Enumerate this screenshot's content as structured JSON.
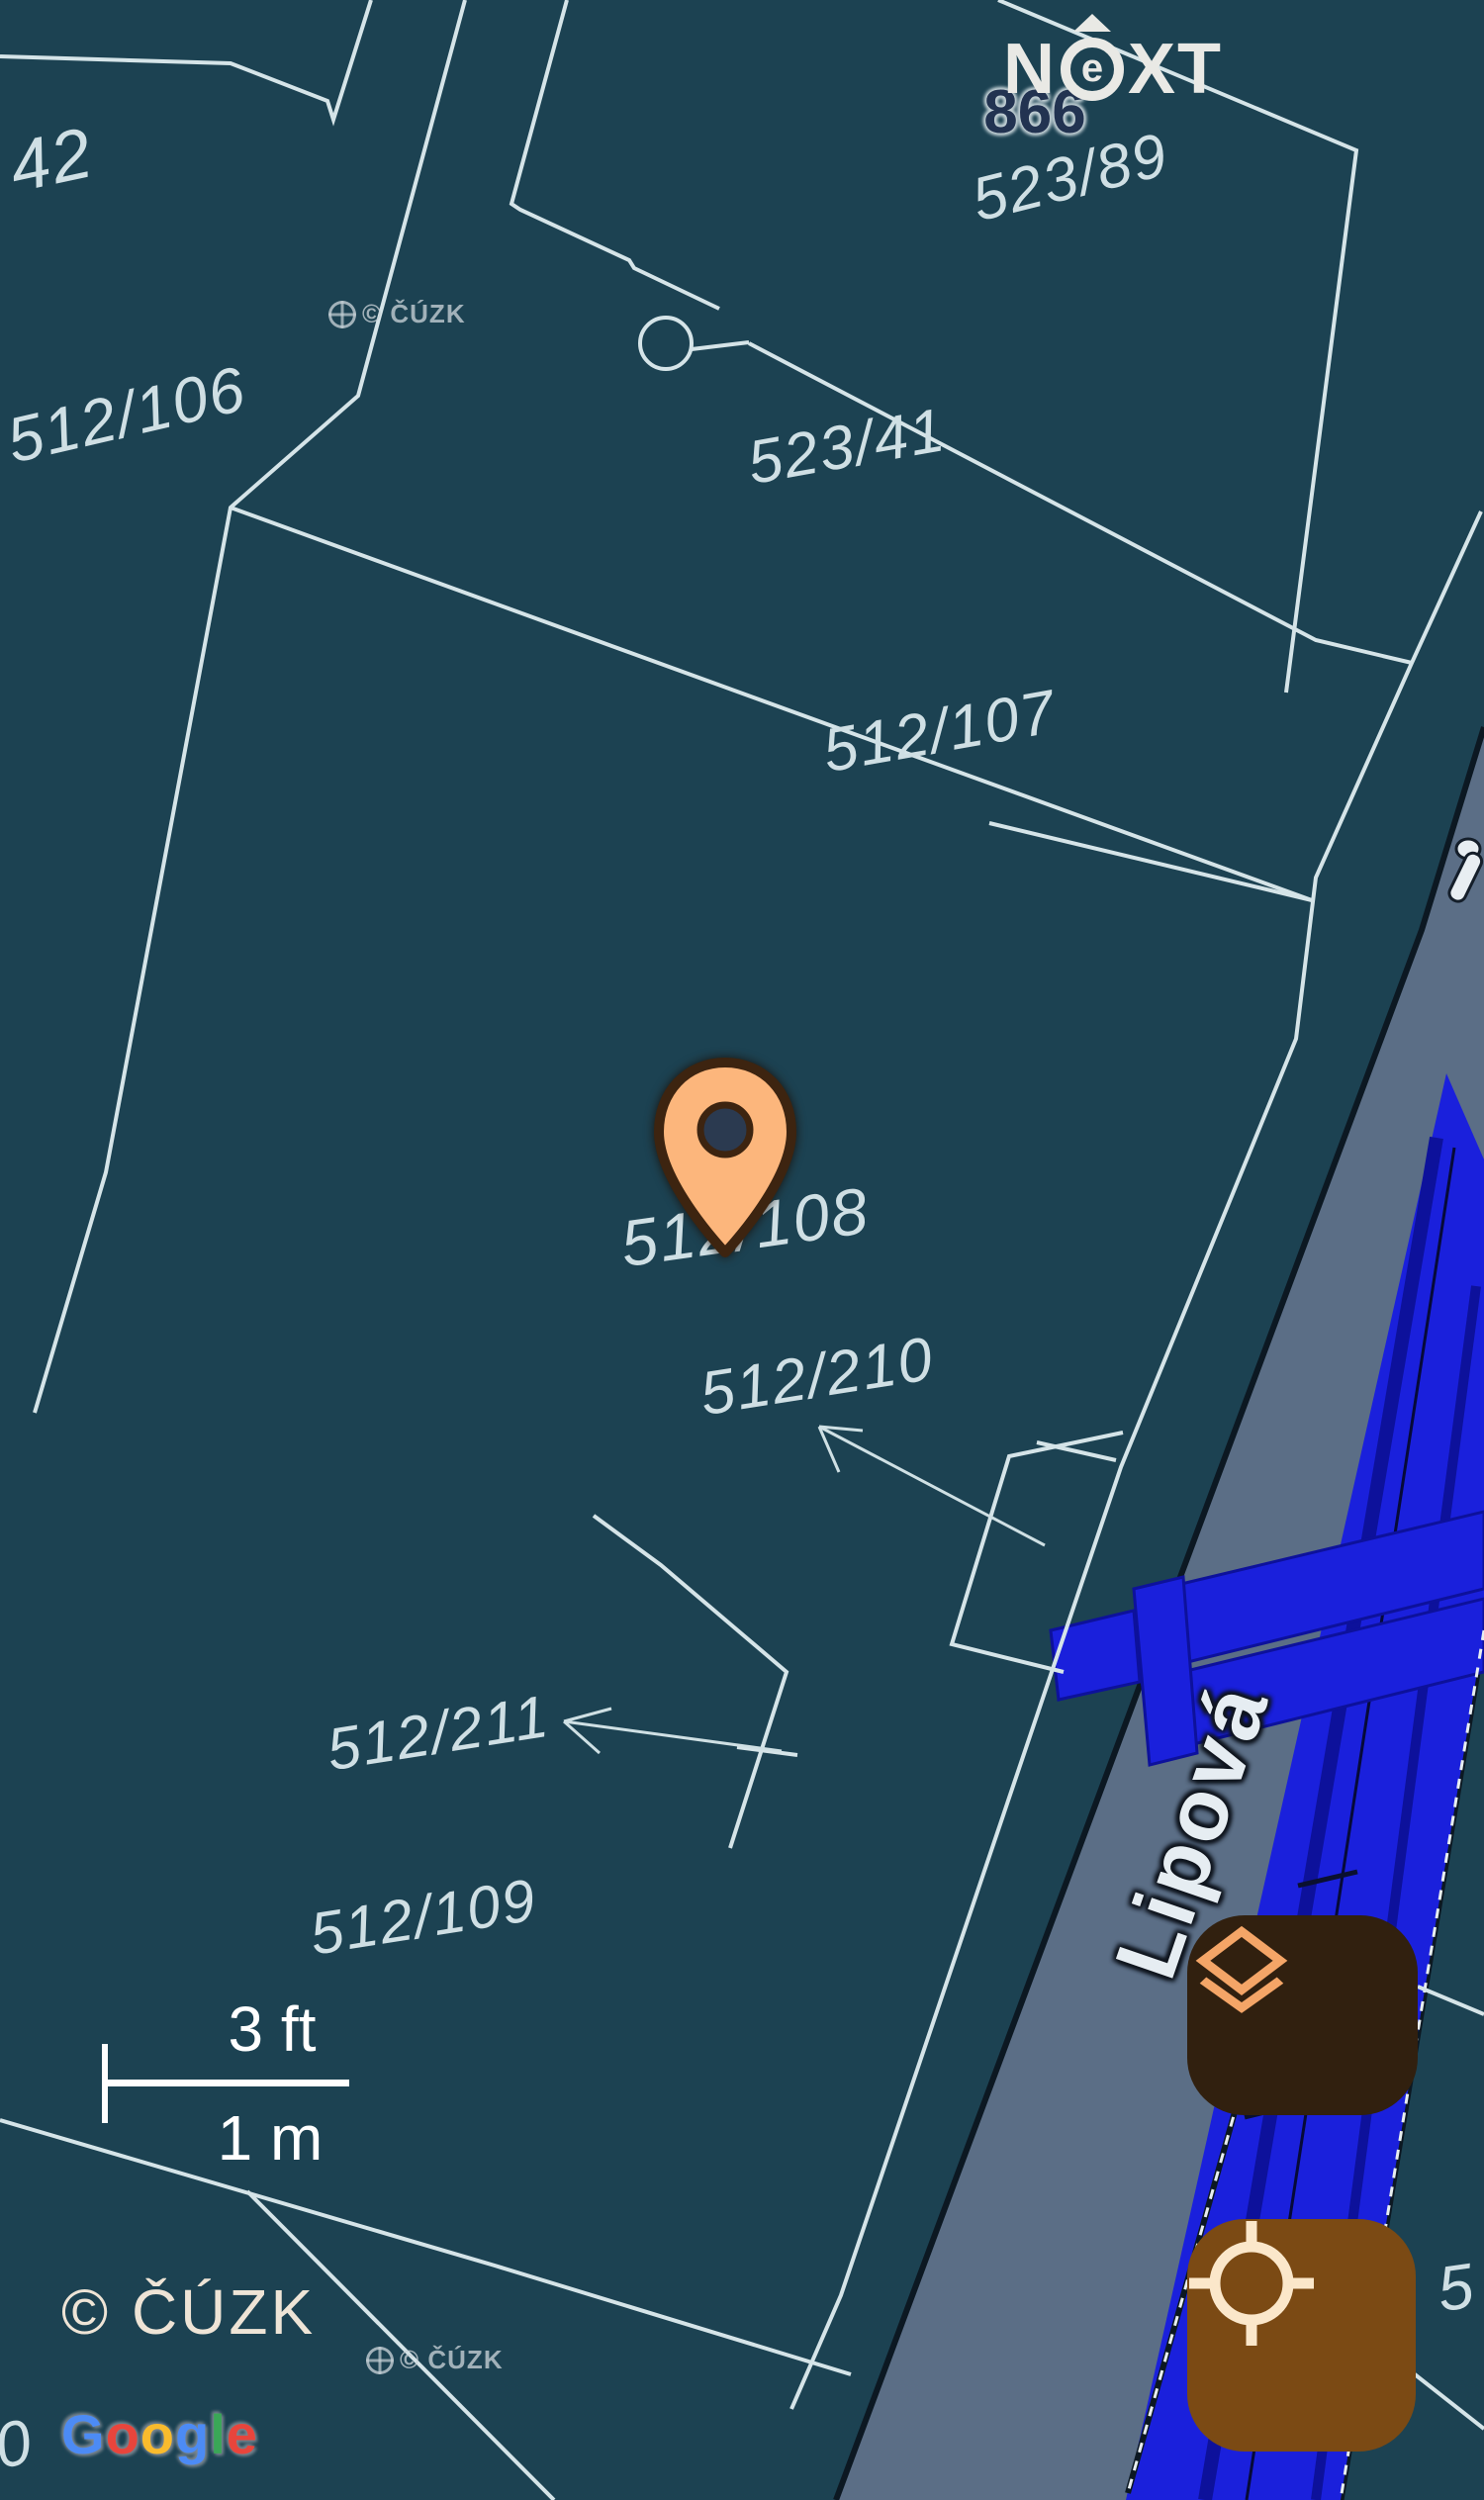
{
  "app": {
    "logo": {
      "n": "N",
      "e": "e",
      "xt": "XT"
    }
  },
  "map": {
    "type": "cadastral-map-with-street-overlay",
    "parcel_labels": [
      {
        "text": "42"
      },
      {
        "text": "512/106"
      },
      {
        "text": "523/89"
      },
      {
        "text": "523/41"
      },
      {
        "text": "512/107"
      },
      {
        "text": "512/108"
      },
      {
        "text": "512/210"
      },
      {
        "text": "512/211"
      },
      {
        "text": "512/109"
      },
      {
        "text": "5"
      },
      {
        "text": "0"
      }
    ],
    "house_number": {
      "text": "866"
    },
    "street": {
      "name": "Lipová"
    },
    "marker": {
      "description": "orange location pin on parcel 512/108"
    },
    "symbols": [
      "well-circle-symbol",
      "leader-arrow-512/210",
      "leader-arrow-512/211"
    ],
    "scale_bar": {
      "imperial": "3 ft",
      "metric": "1 m"
    },
    "watermark_small": "© ČÚZK"
  },
  "attribution": {
    "cuzk": "© ČÚZK",
    "google_letters": [
      {
        "char": "G",
        "color": "#4c8bf5"
      },
      {
        "char": "o",
        "color": "#e8453c"
      },
      {
        "char": "o",
        "color": "#f9bb2d"
      },
      {
        "char": "g",
        "color": "#4c8bf5"
      },
      {
        "char": "l",
        "color": "#3aa757"
      },
      {
        "char": "e",
        "color": "#e8453c"
      }
    ]
  },
  "controls": {
    "layers_button": {
      "icon": "layers-icon"
    },
    "locate_button": {
      "icon": "crosshair-icon"
    }
  },
  "colors": {
    "background": "#1c4252",
    "parcel_line": "#d5e4e8",
    "label_text": "#cfdfe4",
    "road_fill": "#5b6e86",
    "road_edge": "#0c1822",
    "highlight_blue": "#1a20dc",
    "highlight_blue_dark": "#0d119b",
    "pin_fill": "#fcb67c",
    "pin_outline": "#3d2410",
    "layers_button_bg": "#31200f",
    "layers_icon": "#f4a567",
    "locate_button_bg": "#7b4a14",
    "locate_icon": "#fbe7ca",
    "street_label": "#e6edf2",
    "house_number": "#223351",
    "attribution_text": "#eee4d6",
    "scale_text": "#ffffff"
  }
}
